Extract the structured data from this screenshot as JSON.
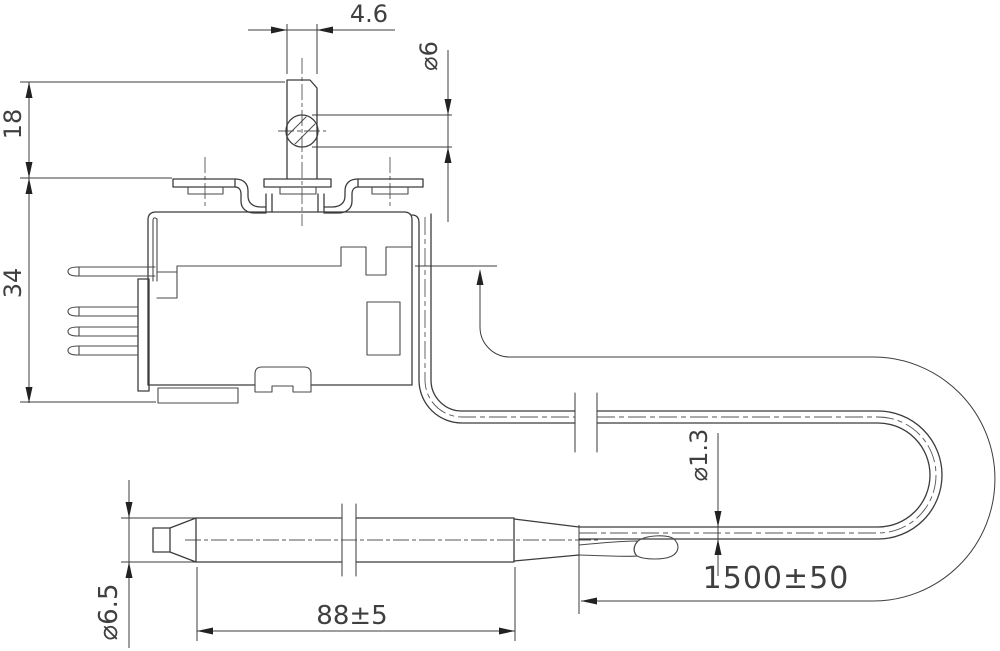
{
  "drawing": {
    "type": "technical-drawing",
    "subject": "Capillary thermostat with sensor bulb",
    "background": "#ffffff",
    "line_color": "#3c3c3c",
    "labels": {
      "stem_width": "4.6",
      "hole_diameter": "⌀6",
      "stem_height": "18",
      "body_height": "34",
      "capillary_diameter": "⌀1.3",
      "capillary_length": "1500±50",
      "bulb_length": "88±5",
      "bulb_diameter": "⌀6.5"
    }
  }
}
